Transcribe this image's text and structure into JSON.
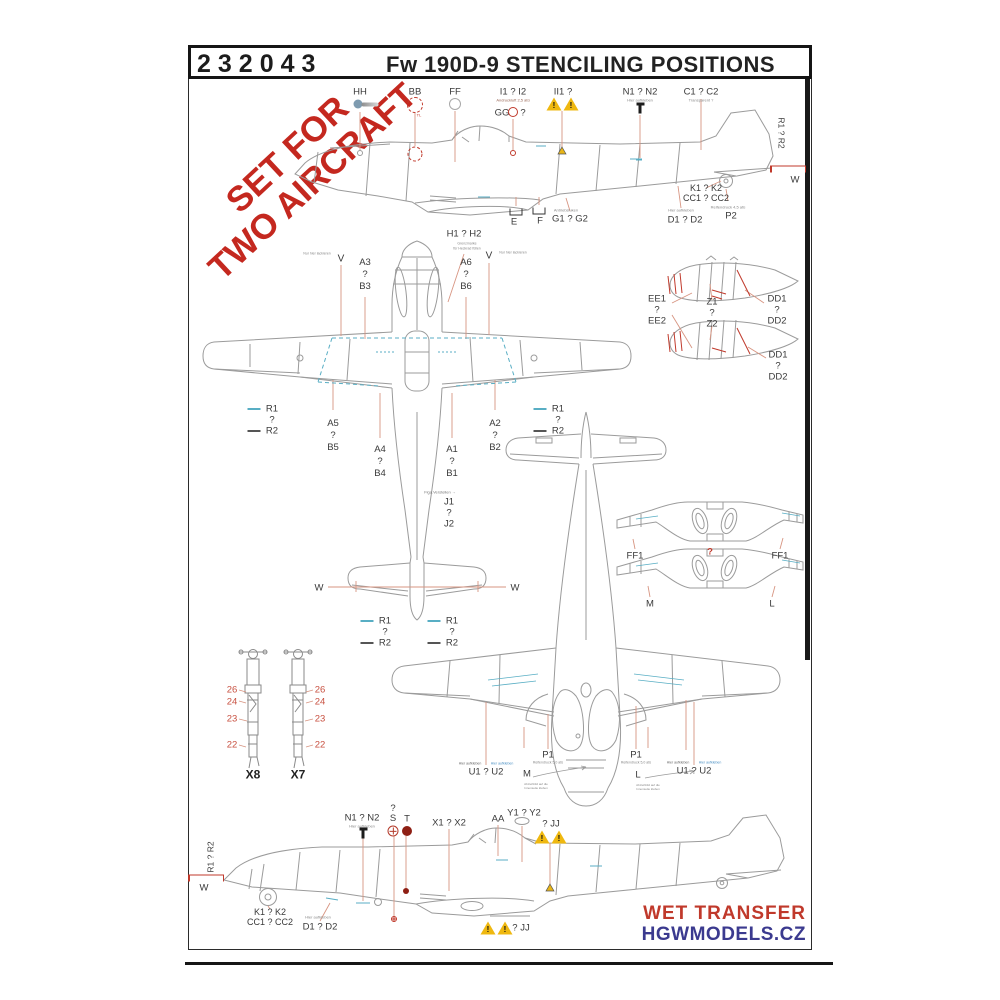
{
  "header": {
    "code": "232043",
    "title": "Fw 190D-9   STENCILING POSITIONS"
  },
  "watermark": {
    "line1": "SET FOR",
    "line2": "TWO AIRCRAFT"
  },
  "footer": {
    "brand_line1": "WET TRANSFER",
    "brand_line2": "HGWMODELS.CZ"
  },
  "colors": {
    "accent_red": "#c0392b",
    "brand_blue": "#3b3a8f",
    "line_gray": "#9b9b9b",
    "leader_red": "#d79582",
    "stencil_cyan": "#58aec4",
    "warning_yellow": "#efb810"
  },
  "annotations": [
    {
      "name": "label-hh",
      "lines": [
        "HH"
      ],
      "x": 360,
      "y": 92
    },
    {
      "icon": "rivet-blue",
      "x": 358,
      "y": 104
    },
    {
      "name": "label-bb",
      "lines": [
        "BB"
      ],
      "x": 415,
      "y": 92
    },
    {
      "icon": "ring-red-dashed",
      "x": 415,
      "y": 105
    },
    {
      "name": "caption-bb",
      "lines": [
        "TL"
      ],
      "x": 419,
      "y": 115,
      "size": 4,
      "color": "#c0392b"
    },
    {
      "name": "label-ff",
      "lines": [
        "FF"
      ],
      "x": 455,
      "y": 92
    },
    {
      "icon": "ring-gray",
      "x": 455,
      "y": 104
    },
    {
      "name": "label-i1-i2",
      "lines": [
        "I1 ? I2"
      ],
      "x": 513,
      "y": 92
    },
    {
      "name": "caption-i1-i2",
      "lines": [
        "Andruckluft 2,5 atü"
      ],
      "x": 513,
      "y": 100,
      "size": 4,
      "color": "#996655"
    },
    {
      "name": "label-gg",
      "lines": [
        "GG"
      ],
      "x": 502,
      "y": 113
    },
    {
      "icon": "ring-red-small",
      "x": 513,
      "y": 112
    },
    {
      "name": "label-gg-question",
      "lines": [
        "?"
      ],
      "x": 523,
      "y": 113
    },
    {
      "name": "label-ii1",
      "lines": [
        "II1 ?"
      ],
      "x": 563,
      "y": 92
    },
    {
      "icon": "warning-triangle",
      "x": 554,
      "y": 104
    },
    {
      "icon": "warning-triangle",
      "x": 571,
      "y": 104
    },
    {
      "name": "label-n1-n2-top",
      "lines": [
        "N1 ? N2"
      ],
      "x": 640,
      "y": 92
    },
    {
      "name": "caption-n1-top",
      "lines": [
        "Hier aufkleben"
      ],
      "x": 640,
      "y": 100,
      "size": 4,
      "color": "#888888"
    },
    {
      "icon": "pin-black",
      "x": 640,
      "y": 109
    },
    {
      "name": "label-c1-c2",
      "lines": [
        "C1 ? C2"
      ],
      "x": 701,
      "y": 92
    },
    {
      "name": "caption-c1-c2",
      "lines": [
        "Transparent ?"
      ],
      "x": 701,
      "y": 100,
      "size": 4,
      "color": "#888888"
    },
    {
      "name": "label-r1-r2-right-rotated",
      "lines": [
        "R1   ?   R2"
      ],
      "x": 781,
      "y": 133,
      "rotate": 90,
      "size": 8.5
    },
    {
      "icon": "wbracket-red",
      "x": 788,
      "y": 170
    },
    {
      "name": "label-w-right",
      "lines": [
        "W"
      ],
      "x": 795,
      "y": 180
    },
    {
      "name": "label-k1-k2-cc1-cc2-top",
      "lines": [
        "K1 ? K2",
        "CC1 ? CC2"
      ],
      "x": 706,
      "y": 193,
      "lh": 10,
      "size": 9
    },
    {
      "name": "caption-d1-d2-top",
      "lines": [
        "Hier aufkleben"
      ],
      "x": 681,
      "y": 210,
      "size": 4,
      "color": "#888888"
    },
    {
      "name": "label-d1-d2-top",
      "lines": [
        "D1 ? D2"
      ],
      "x": 685,
      "y": 220
    },
    {
      "name": "caption-p2",
      "lines": [
        "Reifendruck 4,5 atü"
      ],
      "x": 728,
      "y": 207,
      "size": 4,
      "color": "#888888"
    },
    {
      "name": "label-p2",
      "lines": [
        "P2"
      ],
      "x": 731,
      "y": 216
    },
    {
      "name": "caption-g1-g2",
      "lines": [
        "Antriebsluken"
      ],
      "x": 566,
      "y": 210,
      "size": 4,
      "color": "#888888"
    },
    {
      "name": "label-g1-g2",
      "lines": [
        "G1 ? G2"
      ],
      "x": 570,
      "y": 219
    },
    {
      "icon": "bracket",
      "x": 516,
      "y": 212
    },
    {
      "name": "label-e",
      "lines": [
        "E"
      ],
      "x": 514,
      "y": 222
    },
    {
      "icon": "bracket",
      "x": 539,
      "y": 211
    },
    {
      "name": "label-f",
      "lines": [
        "F"
      ],
      "x": 540,
      "y": 221
    },
    {
      "name": "label-h1-h2",
      "lines": [
        "H1 ? H2"
      ],
      "x": 464,
      "y": 234
    },
    {
      "name": "caption-h1-h2",
      "lines": [
        "Grenzmarke",
        "für Heckrad füllen"
      ],
      "x": 467,
      "y": 246,
      "size": 3.5,
      "lh": 4.5,
      "color": "#888888"
    },
    {
      "name": "caption-v-left",
      "lines": [
        "Nur hier lackieren"
      ],
      "x": 317,
      "y": 254,
      "size": 3.5,
      "color": "#888888"
    },
    {
      "name": "label-v-left",
      "lines": [
        "V"
      ],
      "x": 341,
      "y": 259,
      "size": 10
    },
    {
      "name": "label-a3-b3",
      "lines": [
        "A3",
        "?",
        "B3"
      ],
      "x": 365,
      "y": 275,
      "lh": 12
    },
    {
      "name": "label-a6-b6",
      "lines": [
        "A6",
        "?",
        "B6"
      ],
      "x": 466,
      "y": 275,
      "lh": 12
    },
    {
      "name": "label-v-right",
      "lines": [
        "V"
      ],
      "x": 489,
      "y": 256,
      "size": 10
    },
    {
      "name": "caption-v-right",
      "lines": [
        "Nur hier lackieren"
      ],
      "x": 513,
      "y": 253,
      "size": 3.5,
      "color": "#888888"
    },
    {
      "name": "label-r1-r2-wing-left",
      "lines": [
        "R1",
        "?",
        "R2"
      ],
      "x": 272,
      "y": 420,
      "lh": 11
    },
    {
      "icon": "dash-cyan",
      "x": 254,
      "y": 409
    },
    {
      "icon": "dash-dark",
      "x": 254,
      "y": 431
    },
    {
      "name": "label-a5-b5",
      "lines": [
        "A5",
        "?",
        "B5"
      ],
      "x": 333,
      "y": 436,
      "lh": 12
    },
    {
      "name": "label-a4-b4",
      "lines": [
        "A4",
        "?",
        "B4"
      ],
      "x": 380,
      "y": 462,
      "lh": 12
    },
    {
      "name": "label-a1-b1",
      "lines": [
        "A1",
        "?",
        "B1"
      ],
      "x": 452,
      "y": 462,
      "lh": 12
    },
    {
      "name": "label-a2-b2",
      "lines": [
        "A2",
        "?",
        "B2"
      ],
      "x": 495,
      "y": 436,
      "lh": 12
    },
    {
      "name": "label-r1-r2-wing-right",
      "lines": [
        "R1",
        "?",
        "R2"
      ],
      "x": 558,
      "y": 420,
      "lh": 11
    },
    {
      "icon": "dash-cyan",
      "x": 540,
      "y": 409
    },
    {
      "icon": "dash-dark",
      "x": 540,
      "y": 431
    },
    {
      "name": "caption-j1-j2",
      "lines": [
        "Figa.Verstellen →"
      ],
      "x": 440,
      "y": 492,
      "size": 4,
      "color": "#777777"
    },
    {
      "name": "label-j1-j2",
      "lines": [
        "J1",
        "?",
        "J2"
      ],
      "x": 449,
      "y": 513,
      "lh": 11
    },
    {
      "name": "label-w-tailplane-left",
      "lines": [
        "W"
      ],
      "x": 319,
      "y": 588
    },
    {
      "name": "label-w-tailplane-right",
      "lines": [
        "W"
      ],
      "x": 515,
      "y": 588
    },
    {
      "name": "label-r1-r2-tail-left",
      "lines": [
        "R1",
        "?",
        "R2"
      ],
      "x": 385,
      "y": 632,
      "lh": 11
    },
    {
      "icon": "dash-cyan",
      "x": 367,
      "y": 621
    },
    {
      "icon": "dash-dark",
      "x": 367,
      "y": 643
    },
    {
      "name": "label-r1-r2-tail-right",
      "lines": [
        "R1",
        "?",
        "R2"
      ],
      "x": 452,
      "y": 632,
      "lh": 11
    },
    {
      "icon": "dash-cyan",
      "x": 434,
      "y": 621
    },
    {
      "icon": "dash-dark",
      "x": 434,
      "y": 643
    },
    {
      "name": "label-ee1-ee2",
      "lines": [
        "EE1",
        "?",
        "EE2"
      ],
      "x": 657,
      "y": 310,
      "lh": 11
    },
    {
      "name": "label-z1-z2",
      "lines": [
        "Z1",
        "?",
        "Z2"
      ],
      "x": 712,
      "y": 313,
      "lh": 11
    },
    {
      "name": "label-dd1-dd2-top",
      "lines": [
        "DD1",
        "?",
        "DD2"
      ],
      "x": 777,
      "y": 310,
      "lh": 11
    },
    {
      "name": "label-dd1-dd2-bottom",
      "lines": [
        "DD1",
        "?",
        "DD2"
      ],
      "x": 778,
      "y": 366,
      "lh": 11
    },
    {
      "name": "label-ff1-left",
      "lines": [
        "FF1"
      ],
      "x": 635,
      "y": 556
    },
    {
      "name": "label-cowl-question",
      "lines": [
        "?"
      ],
      "x": 710,
      "y": 552,
      "color": "#c0392b",
      "weight": 700
    },
    {
      "name": "label-ff1-right",
      "lines": [
        "FF1"
      ],
      "x": 780,
      "y": 556
    },
    {
      "name": "label-m-cowl",
      "lines": [
        "M"
      ],
      "x": 650,
      "y": 604
    },
    {
      "name": "label-l-cowl",
      "lines": [
        "L"
      ],
      "x": 772,
      "y": 604
    },
    {
      "name": "gear-left-26",
      "lines": [
        "26"
      ],
      "x": 232,
      "y": 690,
      "color": "#c85040"
    },
    {
      "name": "gear-left-24",
      "lines": [
        "24"
      ],
      "x": 232,
      "y": 702,
      "color": "#c85040"
    },
    {
      "name": "gear-left-23",
      "lines": [
        "23"
      ],
      "x": 232,
      "y": 719,
      "color": "#c85040"
    },
    {
      "name": "gear-left-22",
      "lines": [
        "22"
      ],
      "x": 232,
      "y": 745,
      "color": "#c85040"
    },
    {
      "name": "gear-right-26",
      "lines": [
        "26"
      ],
      "x": 320,
      "y": 690,
      "color": "#c85040"
    },
    {
      "name": "gear-right-24",
      "lines": [
        "24"
      ],
      "x": 320,
      "y": 702,
      "color": "#c85040"
    },
    {
      "name": "gear-right-23",
      "lines": [
        "23"
      ],
      "x": 320,
      "y": 719,
      "color": "#c85040"
    },
    {
      "name": "gear-right-22",
      "lines": [
        "22"
      ],
      "x": 320,
      "y": 745,
      "color": "#c85040"
    },
    {
      "name": "label-x8",
      "lines": [
        "X8"
      ],
      "x": 253,
      "y": 775,
      "weight": 700,
      "size": 12,
      "color": "#222222"
    },
    {
      "name": "label-x7",
      "lines": [
        "X7"
      ],
      "x": 298,
      "y": 775,
      "weight": 700,
      "size": 12,
      "color": "#222222"
    },
    {
      "name": "label-p1-left",
      "lines": [
        "P1"
      ],
      "x": 548,
      "y": 755
    },
    {
      "name": "caption-p1-left",
      "lines": [
        "Reifendruck 5,0 atü"
      ],
      "x": 548,
      "y": 763,
      "size": 3.5,
      "color": "#888888"
    },
    {
      "name": "label-p1-right",
      "lines": [
        "P1"
      ],
      "x": 636,
      "y": 755
    },
    {
      "name": "caption-p1-right",
      "lines": [
        "Reifendruck 5,0 atü"
      ],
      "x": 636,
      "y": 763,
      "size": 3.5,
      "color": "#888888"
    },
    {
      "name": "caption-u-left-black",
      "lines": [
        "Hier aufkleben"
      ],
      "x": 470,
      "y": 764,
      "size": 3.5,
      "color": "#666666"
    },
    {
      "name": "caption-u-left-blue",
      "lines": [
        "Hier aufkleben"
      ],
      "x": 502,
      "y": 764,
      "size": 3.5,
      "color": "#4a90c4"
    },
    {
      "name": "label-u1-u2-left",
      "lines": [
        "U1   ?   U2"
      ],
      "x": 486,
      "y": 772
    },
    {
      "name": "label-m-bay",
      "lines": [
        "M"
      ],
      "x": 527,
      "y": 774
    },
    {
      "name": "caption-m-bay",
      "lines": [
        "Abziehbild auf die",
        "Innenseite kleben"
      ],
      "x": 536,
      "y": 786,
      "size": 3,
      "lh": 4,
      "color": "#888888"
    },
    {
      "name": "label-l-bay",
      "lines": [
        "L"
      ],
      "x": 638,
      "y": 775
    },
    {
      "name": "caption-l-bay",
      "lines": [
        "Abziehbild auf die",
        "Innenseite kleben"
      ],
      "x": 648,
      "y": 787,
      "size": 3,
      "lh": 4,
      "color": "#888888"
    },
    {
      "name": "caption-u-right-black",
      "lines": [
        "Hier aufkleben"
      ],
      "x": 678,
      "y": 763,
      "size": 3.5,
      "color": "#666666"
    },
    {
      "name": "caption-u-right-blue",
      "lines": [
        "Hier aufkleben"
      ],
      "x": 710,
      "y": 763,
      "size": 3.5,
      "color": "#4a90c4"
    },
    {
      "name": "label-u1-u2-right",
      "lines": [
        "U1   ?   U2"
      ],
      "x": 694,
      "y": 771
    },
    {
      "name": "label-n1-n2-bottom",
      "lines": [
        "N1 ? N2"
      ],
      "x": 362,
      "y": 818
    },
    {
      "name": "caption-n1-bottom",
      "lines": [
        "Hier aufkleben"
      ],
      "x": 362,
      "y": 826,
      "size": 4,
      "color": "#888888"
    },
    {
      "icon": "pin-black",
      "x": 363,
      "y": 834
    },
    {
      "name": "label-s",
      "lines": [
        "?",
        "S"
      ],
      "x": 393,
      "y": 814,
      "lh": 10
    },
    {
      "name": "label-t",
      "lines": [
        "T"
      ],
      "x": 407,
      "y": 819
    },
    {
      "icon": "circle-cross-red",
      "x": 393,
      "y": 831
    },
    {
      "icon": "dot-darkred",
      "x": 407,
      "y": 831
    },
    {
      "name": "label-x1-x2",
      "lines": [
        "X1 ? X2"
      ],
      "x": 449,
      "y": 823
    },
    {
      "name": "label-aa",
      "lines": [
        "AA"
      ],
      "x": 498,
      "y": 819
    },
    {
      "name": "label-y1-y2",
      "lines": [
        "Y1 ? Y2"
      ],
      "x": 524,
      "y": 813
    },
    {
      "icon": "oval-gray",
      "x": 522,
      "y": 821
    },
    {
      "name": "label-jj-upper",
      "lines": [
        "? JJ"
      ],
      "x": 551,
      "y": 824
    },
    {
      "icon": "warning-triangle",
      "x": 542,
      "y": 837
    },
    {
      "icon": "warning-triangle",
      "x": 559,
      "y": 837
    },
    {
      "name": "label-r1-r2-left-rotated",
      "lines": [
        "R1   ?   R2"
      ],
      "x": 211,
      "y": 857,
      "rotate": -90,
      "size": 8.5
    },
    {
      "icon": "wbracket-red",
      "x": 206,
      "y": 879
    },
    {
      "name": "label-w-bottom",
      "lines": [
        "W"
      ],
      "x": 204,
      "y": 888
    },
    {
      "name": "label-k1-k2-cc1-cc2-bottom",
      "lines": [
        "K1 ? K2",
        "CC1 ? CC2"
      ],
      "x": 270,
      "y": 917,
      "lh": 10,
      "size": 9
    },
    {
      "name": "caption-d1-d2-bottom",
      "lines": [
        "Hier aufkleben"
      ],
      "x": 318,
      "y": 917,
      "size": 4,
      "color": "#888888"
    },
    {
      "name": "label-d1-d2-bottom",
      "lines": [
        "D1 ? D2"
      ],
      "x": 320,
      "y": 927
    },
    {
      "icon": "warning-triangle",
      "x": 488,
      "y": 928
    },
    {
      "icon": "warning-triangle",
      "x": 505,
      "y": 928
    },
    {
      "name": "label-jj-lower",
      "lines": [
        "? JJ"
      ],
      "x": 521,
      "y": 928
    }
  ]
}
